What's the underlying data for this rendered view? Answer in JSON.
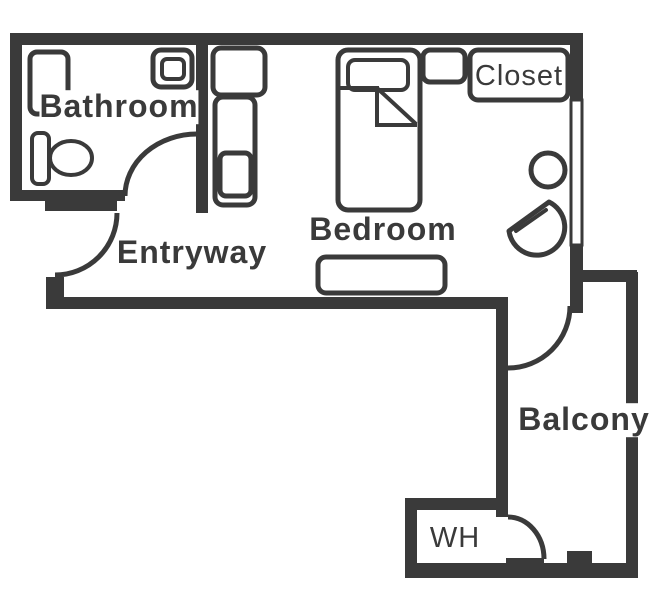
{
  "labels": {
    "bathroom": "Bathroom",
    "entryway": "Entryway",
    "bedroom": "Bedroom",
    "closet": "Closet",
    "balcony": "Balcony",
    "water_heater": "WH"
  },
  "colors": {
    "wall": "#3a3a3a",
    "background": "#ffffff",
    "label_text": "#3a3a3a"
  }
}
